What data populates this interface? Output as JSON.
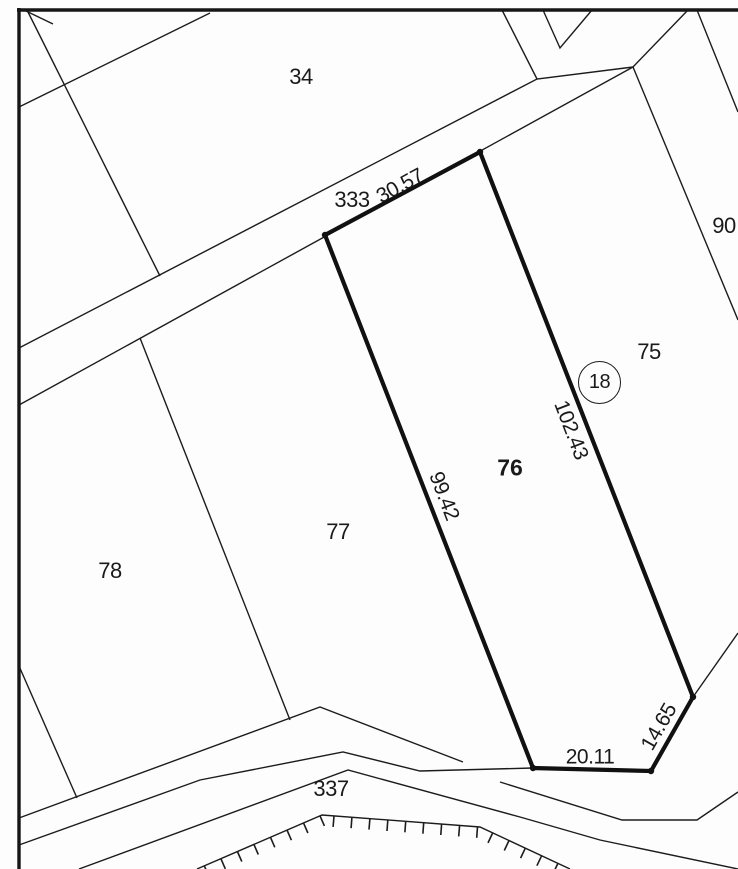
{
  "map": {
    "parcels": {
      "p34": "34",
      "p75": "75",
      "p76": "76",
      "p77": "77",
      "p78": "78",
      "p90": "90"
    },
    "roads": {
      "r333": "333",
      "r337": "337"
    },
    "survey_marker": {
      "number": "18"
    },
    "dimensions": {
      "top_edge": "30.57",
      "right_edge": "102.43",
      "left_edge": "99.42",
      "bottom_edge": "20.11",
      "bottom_right_edge": "14.65"
    },
    "colors": {
      "ink": "#1c1c1c",
      "paper": "#fdfdfd"
    }
  }
}
